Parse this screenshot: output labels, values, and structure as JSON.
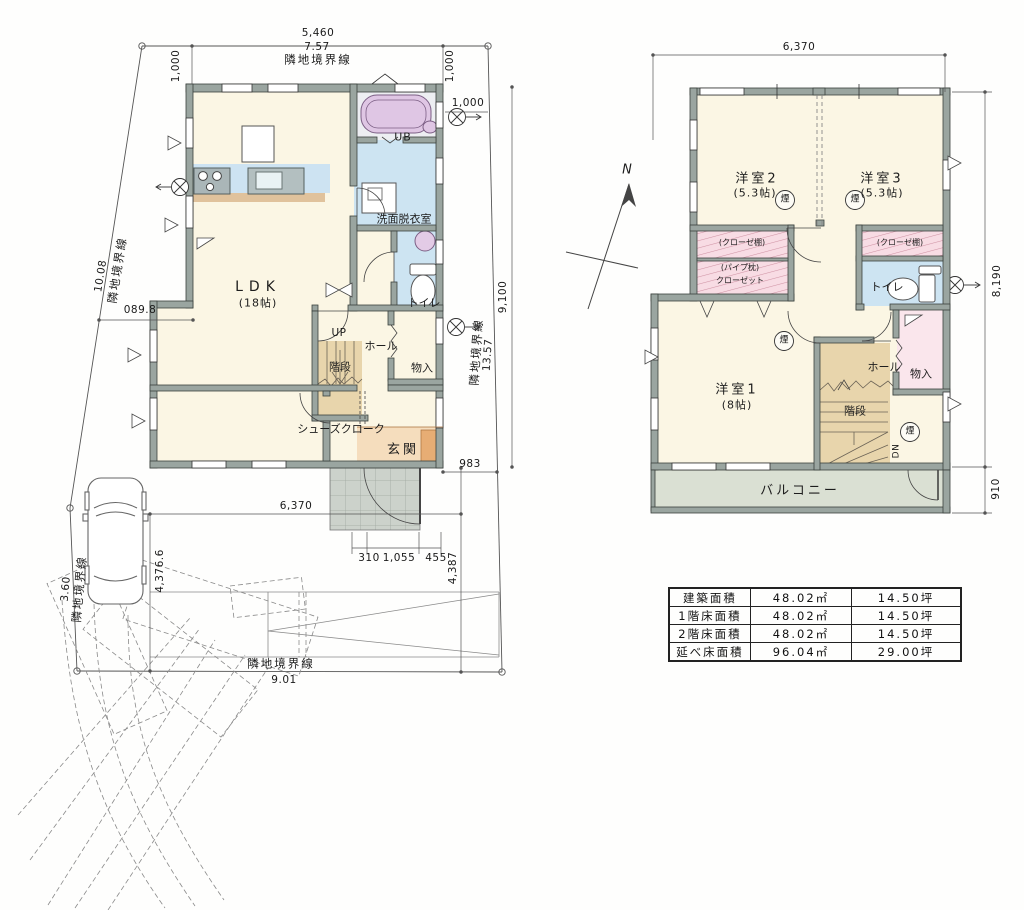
{
  "floor1": {
    "rooms": {
      "ldk": "LDK",
      "ldk_size": "(18帖)",
      "ub": "UB",
      "washroom": "洗面脱衣室",
      "toilet": "トイレ",
      "up": "UP",
      "hall": "ホール",
      "stairs": "階段",
      "storage": "物入",
      "shoe_closet": "シューズクローク",
      "entrance": "玄関"
    },
    "dims": {
      "top_w": "5,460",
      "top_w_m": "7.57",
      "offset_left": "1,000",
      "offset_right": "1,000",
      "offset_right2": "1,000",
      "height": "9,100",
      "boundary_right_len": "13.57",
      "gap_right": "983",
      "bottom_w": "6,370",
      "porch_a": "310",
      "porch_b": "1,055",
      "porch_c": "455",
      "south": "4,387",
      "parking": "4,376.6",
      "boundary_left_len": "10.08",
      "step_left": "089.8",
      "boundary_sw_len": "3.60",
      "boundary_bottom_len": "9.01"
    },
    "boundaries": {
      "top": "隣地境界線",
      "left": "隣地境界線",
      "right": "隣地境界線",
      "sw": "隣地境界線",
      "bottom": "隣地境界線"
    }
  },
  "floor2": {
    "rooms": {
      "room2": "洋室2",
      "room2_size": "(5.3帖)",
      "room3": "洋室3",
      "room3_size": "(5.3帖)",
      "room1": "洋室1",
      "room1_size": "(8帖)",
      "closet_shelf": "(クローゼ棚)",
      "closet_pipe": "(パイプ枕)",
      "closet": "クローゼット",
      "toilet": "トイレ",
      "storage": "物入",
      "hall": "ホール",
      "stairs": "階段",
      "dn": "DN",
      "balcony": "バルコニー"
    },
    "smoke": "煙",
    "dims": {
      "top_w": "6,370",
      "height": "8,190",
      "balcony_d": "910"
    }
  },
  "north_label": "N",
  "area_table": {
    "rows": [
      {
        "label": "建築面積",
        "sqm": "48.02㎡",
        "tsubo": "14.50坪"
      },
      {
        "label": "1階床面積",
        "sqm": "48.02㎡",
        "tsubo": "14.50坪"
      },
      {
        "label": "2階床面積",
        "sqm": "48.02㎡",
        "tsubo": "14.50坪"
      },
      {
        "label": "延べ床面積",
        "sqm": "96.04㎡",
        "tsubo": "29.00坪"
      }
    ]
  }
}
